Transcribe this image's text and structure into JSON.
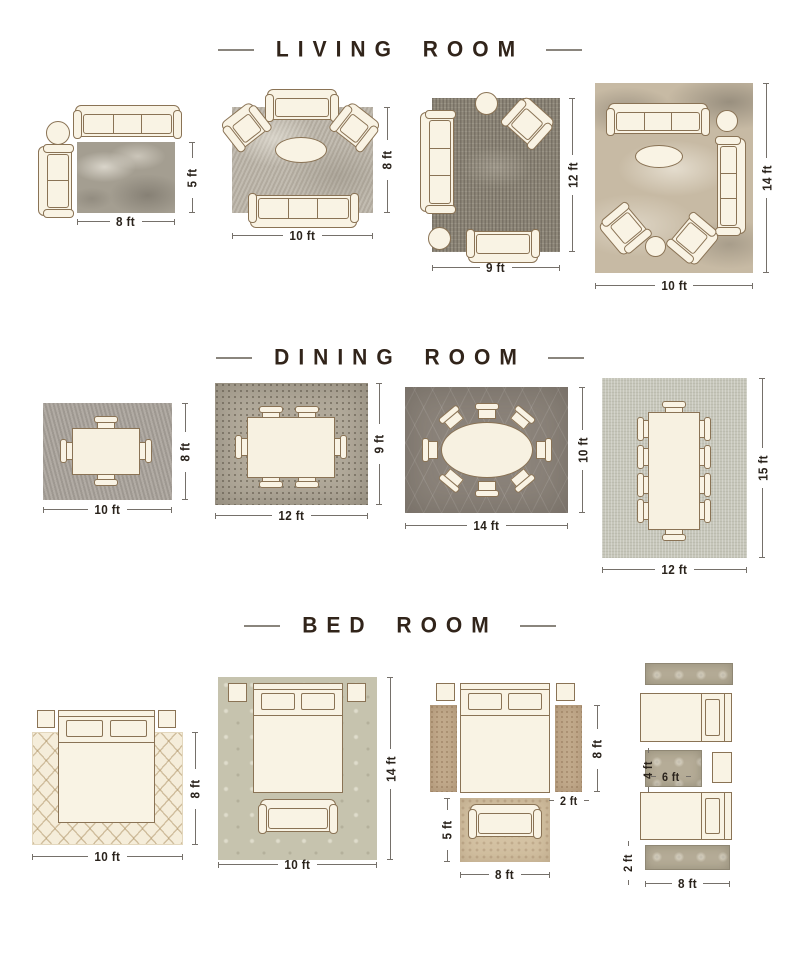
{
  "sections": [
    {
      "title": "LIVING ROOM",
      "layouts": [
        {
          "w": "8 ft",
          "h": "5 ft",
          "furniture": [
            "three-seat-sofa",
            "round-side-table",
            "loveseat"
          ]
        },
        {
          "w": "10 ft",
          "h": "8 ft",
          "furniture": [
            "loveseat",
            "armchair",
            "armchair",
            "oval-coffee-table",
            "three-seat-sofa"
          ]
        },
        {
          "w": "9 ft",
          "h": "12 ft",
          "furniture": [
            "three-seat-sofa",
            "round-side-table",
            "armchair",
            "round-side-table",
            "loveseat"
          ]
        },
        {
          "w": "10 ft",
          "h": "14 ft",
          "furniture": [
            "three-seat-sofa",
            "round-side-table",
            "three-seat-sofa",
            "oval-coffee-table",
            "armchair",
            "armchair",
            "round-side-table"
          ]
        }
      ]
    },
    {
      "title": "DINING ROOM",
      "layouts": [
        {
          "w": "10 ft",
          "h": "8 ft",
          "furniture": [
            "dining-table",
            "4 dining-chairs"
          ]
        },
        {
          "w": "12 ft",
          "h": "9 ft",
          "furniture": [
            "dining-table",
            "6 dining-chairs"
          ]
        },
        {
          "w": "14 ft",
          "h": "10 ft",
          "furniture": [
            "oval-dining-table",
            "8 dining-chairs"
          ]
        },
        {
          "w": "12 ft",
          "h": "15 ft",
          "furniture": [
            "dining-table",
            "10 dining-chairs"
          ]
        }
      ]
    },
    {
      "title": "BED ROOM",
      "layouts": [
        {
          "w": "10 ft",
          "h": "8 ft",
          "furniture": [
            "bed",
            "nightstand",
            "nightstand"
          ]
        },
        {
          "w": "10 ft",
          "h": "14 ft",
          "furniture": [
            "bed",
            "nightstand",
            "nightstand",
            "bench"
          ]
        },
        {
          "w": "8 ft",
          "h": "8 ft",
          "runner_w": "2 ft",
          "front_h": "5 ft",
          "furniture": [
            "bed",
            "nightstand",
            "nightstand",
            "runner-rug",
            "runner-rug",
            "bench"
          ]
        },
        {
          "w": "8 ft",
          "runner_h": "2 ft",
          "mid_w": "6 ft",
          "mid_h": "4 ft",
          "furniture": [
            "twin-bed",
            "twin-bed",
            "nightstand",
            "runner-rug",
            "runner-rug"
          ]
        }
      ]
    }
  ],
  "colors": {
    "title_text": "#31241a",
    "dimension_text": "#2a231c",
    "dimension_line": "#75706a",
    "furniture_fill": "#f9f3e4",
    "furniture_outline": "#8a7355"
  }
}
